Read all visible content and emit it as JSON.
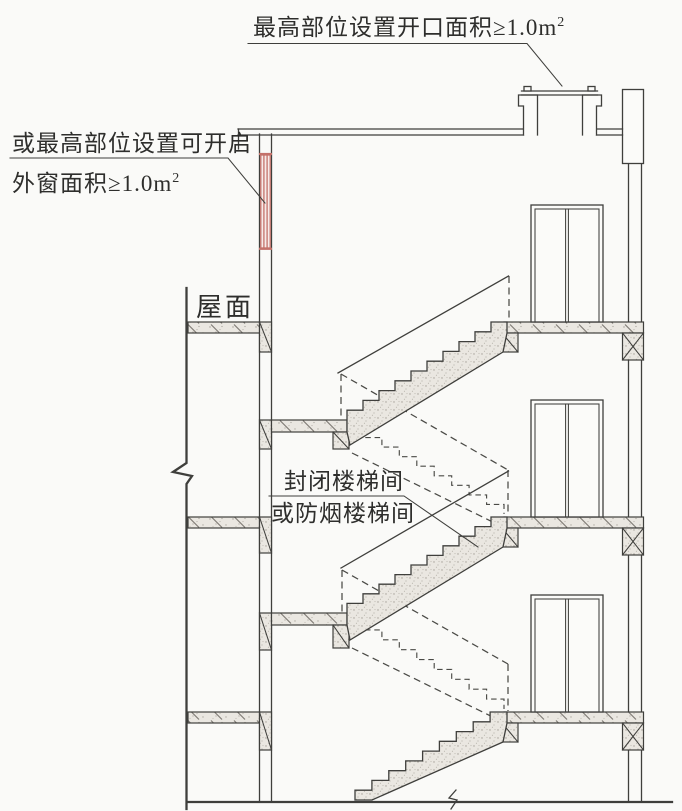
{
  "annotations": {
    "roof_opening": {
      "text": "最高部位设置开口面积≥1.0m",
      "sup": "2"
    },
    "openable_window": {
      "line1": "或最高部位设置可开启",
      "line2": "外窗面积≥1.0m",
      "sup": "2"
    },
    "roof_label": "屋面",
    "stairwell": {
      "line1": "封闭楼梯间",
      "line2": "或防烟楼梯间"
    }
  },
  "colors": {
    "line": "#3f3f3c",
    "window_red": "#c4716a"
  }
}
